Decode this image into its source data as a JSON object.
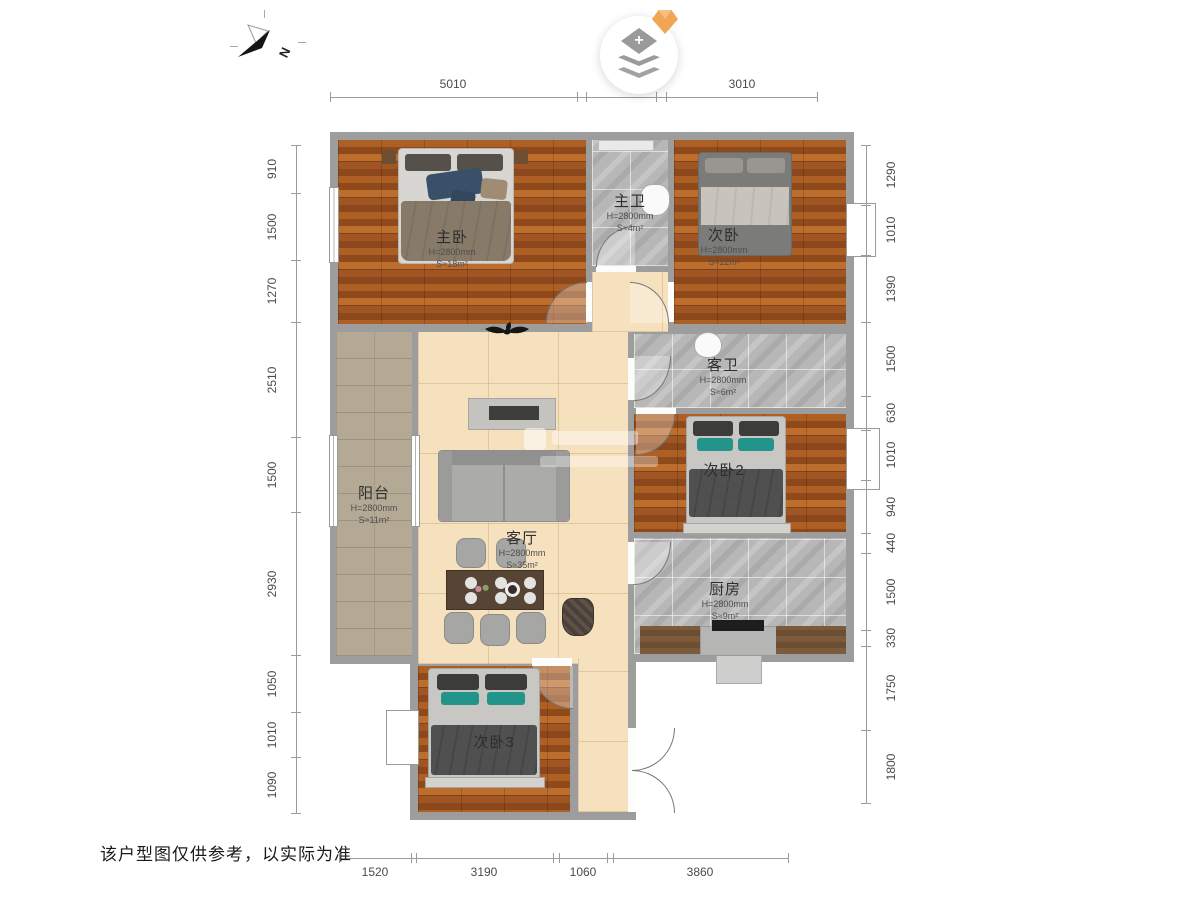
{
  "compass": {
    "label": "N"
  },
  "logo": {
    "plus": "+"
  },
  "footer": {
    "disclaimer": "该户型图仅供参考，以实际为准"
  },
  "rooms": {
    "master": {
      "name": "主卧",
      "h": "H=2800mm",
      "s": "S≈18m²"
    },
    "master_bath": {
      "name": "主卫",
      "h": "H=2800mm",
      "s": "S≈4m²"
    },
    "bedroom2": {
      "name": "次卧",
      "h": "H=2800mm",
      "s": "S≈12m²"
    },
    "guest_bath": {
      "name": "客卫",
      "h": "H=2800mm",
      "s": "S≈6m²"
    },
    "bedroom2b": {
      "name": "次卧2",
      "h": "H=2800mm",
      "s": "S≈10m²"
    },
    "kitchen": {
      "name": "厨房",
      "h": "H=2800mm",
      "s": "S≈9m²"
    },
    "balcony": {
      "name": "阳台",
      "h": "H=2800mm",
      "s": "S≈11m²"
    },
    "living": {
      "name": "客厅",
      "h": "H=2800mm",
      "s": "S≈35m²"
    },
    "bedroom3": {
      "name": "次卧3",
      "h": "H=2800mm",
      "s": "S≈10m²"
    }
  },
  "dims": {
    "top": [
      "5010",
      "3010"
    ],
    "bottom": [
      "1520",
      "3190",
      "1060",
      "3860"
    ],
    "left": [
      "910",
      "1500",
      "1270",
      "2510",
      "1500",
      "2930",
      "1050",
      "1010",
      "1090"
    ],
    "right": [
      "1290",
      "1010",
      "1390",
      "1500",
      "630",
      "1010",
      "940",
      "440",
      "1500",
      "330",
      "1750",
      "1800"
    ]
  }
}
